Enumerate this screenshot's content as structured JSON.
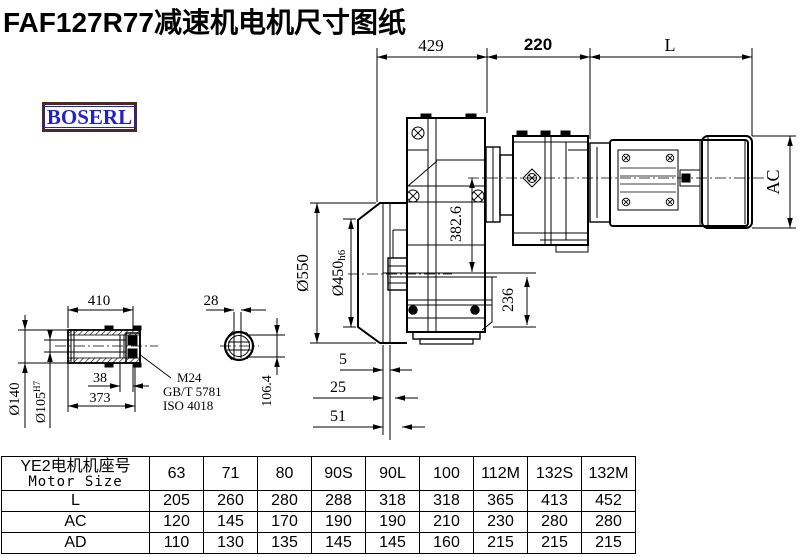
{
  "title": "FAF127R77减速机电机尺寸图纸",
  "logo": {
    "text": "BOSERL",
    "border_color": "#4a2a23",
    "text_color": "#2222cc"
  },
  "drawing": {
    "dims": {
      "d429": "429",
      "d220": "220",
      "dL": "L",
      "dAC": "AC",
      "d550": "Ø550",
      "d450": "Ø450",
      "d450_suffix": "h6",
      "d382": "382.6",
      "d236": "236",
      "d5": "5",
      "d25": "25",
      "d51": "51"
    },
    "shaft_view": {
      "d410": "410",
      "d28": "28",
      "d140": "Ø140",
      "d105": "Ø105",
      "d105_sup": "H7",
      "d38": "38",
      "d373": "373",
      "d106": "106.4",
      "note_line1": "M24",
      "note_line2": "GB/T 5781",
      "note_line3": "ISO 4018"
    }
  },
  "table": {
    "header": {
      "line1": "YE2电机机座号",
      "line2": "Motor Size"
    },
    "columns": [
      "63",
      "71",
      "80",
      "90S",
      "90L",
      "100",
      "112M",
      "132S",
      "132M"
    ],
    "rows": [
      {
        "label": "L",
        "values": [
          "205",
          "260",
          "280",
          "288",
          "318",
          "318",
          "365",
          "413",
          "452"
        ]
      },
      {
        "label": "AC",
        "values": [
          "120",
          "145",
          "170",
          "190",
          "190",
          "210",
          "230",
          "280",
          "280"
        ]
      },
      {
        "label": "AD",
        "values": [
          "110",
          "130",
          "135",
          "145",
          "145",
          "160",
          "215",
          "215",
          "215"
        ]
      }
    ]
  }
}
